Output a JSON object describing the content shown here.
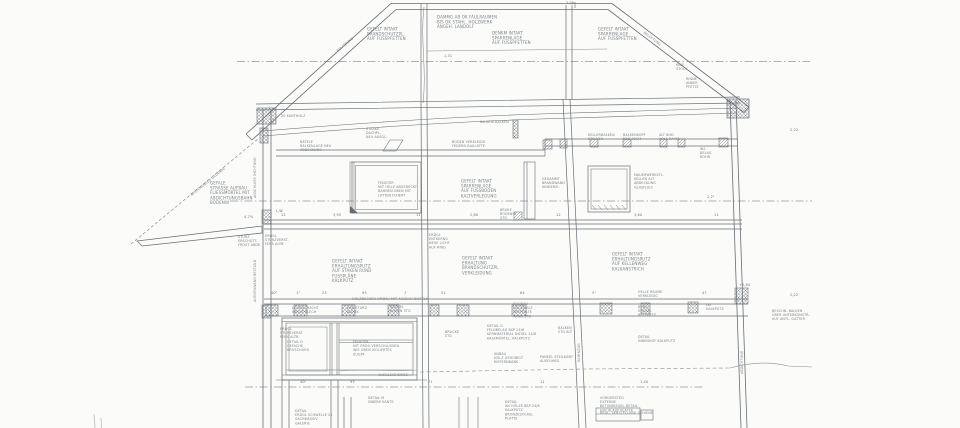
{
  "drawing": {
    "type": "architectural-section-scan",
    "colors": {
      "paper": "#fbfbf9",
      "ink": "#686e74",
      "light_ink": "#8b9095",
      "hatch": "#70767b",
      "centerline": "#94999d",
      "annotation_text": "#7d8388"
    }
  },
  "annotations": [
    {
      "x": 367,
      "y": 27,
      "t": "GEFELT INTAKT\nBRANDSCHUTZPL.\nAUF FUSSPFETTEN"
    },
    {
      "x": 437,
      "y": 15,
      "t": "DÄMMG AB OK FAULRÄUMEN\nBIS OK STAHL. HOLZWERK\nANGEH. LANDOLF"
    },
    {
      "x": 492,
      "y": 31,
      "t": "DENKM INTAKT\nSPARRENLAGE\nAUF FUSSPFETTEN"
    },
    {
      "x": 598,
      "y": 27,
      "t": "GEFELT INTAKT\nSPARRENLAGE\nAUF FUSSPFETTEN"
    },
    {
      "x": 676,
      "y": 63,
      "t": "KNIE-\nSTOCK",
      "c": "xs"
    },
    {
      "x": 686,
      "y": 77,
      "t": "RINNE\nANKER\nPFETTE",
      "c": "xs"
    },
    {
      "x": 336,
      "y": 50,
      "r": -40,
      "t": "BELATTUNG",
      "c": "xs"
    },
    {
      "x": 645,
      "y": 31,
      "r": 37,
      "t": "BELÜFTUNG",
      "c": "xs"
    },
    {
      "x": 480,
      "y": 120,
      "t": "NA KEHLBALKEN",
      "c": "xs"
    },
    {
      "x": 281,
      "y": 114,
      "t": "20 KANTHOLZ",
      "c": "xs"
    },
    {
      "x": 300,
      "y": 140,
      "t": "BATELE\nBALKENLAGE NEU\nABDECKUNG",
      "c": "xs"
    },
    {
      "x": 366,
      "y": 127,
      "t": "STÄRKE\nDACHPL.\nNEU AUSGL.",
      "c": "xs"
    },
    {
      "x": 452,
      "y": 140,
      "t": "BODEN VERKLEIDG\nFEDERN BAULATTE",
      "c": "xs"
    },
    {
      "x": 588,
      "y": 133,
      "t": "KELLERBALKEN\nSTG NEU",
      "c": "xs"
    },
    {
      "x": 623,
      "y": 133,
      "t": "BALKENKOPF\nNEU 20/24",
      "c": "xs"
    },
    {
      "x": 659,
      "y": 133,
      "t": "ALT BHD\nVOLL RAHM",
      "c": "xs"
    },
    {
      "x": 700,
      "y": 147,
      "t": "WS\nBELAG\nROHR",
      "c": "xs"
    },
    {
      "x": 210,
      "y": 181,
      "t": "GEFALE\nSTRASSE AUFBAU\nFLIESSMÖRTEL MIT\nABDICHTUNGSBAHN\nBODENW"
    },
    {
      "x": 378,
      "y": 181,
      "t": "FENSTER\nMIT HOLZ ABGEDECKT\nBAHNEN OBEN MIT\nLATTEN FIXIERT",
      "c": "xs"
    },
    {
      "x": 461,
      "y": 179,
      "t": "GEFELT INTAKT\nSPARRENLAGE\nAUF FUSSBODEN\nKALTVERLEGUNG"
    },
    {
      "x": 542,
      "y": 177,
      "t": "GEDÄMMT\nBRANDWAND\nKINDERZI.",
      "c": "xs"
    },
    {
      "x": 634,
      "y": 173,
      "t": "MAUERWERKSFL.\nKELLEN ALT\nABDECKUNG\nGLASFLIES",
      "c": "xs"
    },
    {
      "x": 500,
      "y": 208,
      "t": "BRÜKE\nBODENPL.\nSTG",
      "c": "xs"
    },
    {
      "x": 707,
      "y": 195,
      "t": "2,2¹",
      "c": "dim"
    },
    {
      "x": 265,
      "y": 234,
      "t": "ERDGL\nSTURZVERST.\nFENS ALTB",
      "c": "xs"
    },
    {
      "x": 429,
      "y": 233,
      "t": "ERDGL\nENTKERNG\nNEUE LICHT\nAUF RING",
      "c": "xs"
    },
    {
      "x": 332,
      "y": 259,
      "t": "GEFELT INTAKT\nERHALTUNGSPUTZ\nAUF STAKEN RUND\nFUSSPLÄNE\nKALKPUTZ"
    },
    {
      "x": 462,
      "y": 256,
      "t": "GEFELT INTAKT\nERHALTUNG\nBRANDSCHUTZPL\nVERKLEIDUNG"
    },
    {
      "x": 612,
      "y": 252,
      "t": "GEFELT INTAKT\nERHALTUNGSPUTZ\nAUF KELLENWEG\nKALKANSTRICH"
    },
    {
      "x": 638,
      "y": 290,
      "t": "HELLE RÄUME\nVERKLEIDG",
      "c": "xs"
    },
    {
      "x": 352,
      "y": 297,
      "t": "HOLZDECKEN UMBAU MIT AUSBAU DISTELN",
      "c": "xs"
    },
    {
      "x": 292,
      "y": 306,
      "t": "LICHTSCHACHT\nWELLE BLECH",
      "c": "xs"
    },
    {
      "x": 347,
      "y": 306,
      "t": "ERD STURZ\nALT BK",
      "c": "xs"
    },
    {
      "x": 390,
      "y": 305,
      "t": "NACKEL\nBODEN STG",
      "c": "xs"
    },
    {
      "x": 513,
      "y": 302,
      "t": "ROHBAU\nHOLZDIELE\nABSTELLTE\nRAND STG",
      "c": "xs"
    },
    {
      "x": 638,
      "y": 305,
      "t": "BERG.\nSOCKEL\nBETONFTE",
      "c": "xs"
    },
    {
      "x": 706,
      "y": 303,
      "t": "LW\nKALKPUTZ",
      "c": "xs"
    },
    {
      "x": 772,
      "y": 309,
      "t": "BESCHN. BALKEN\nÜBER UNTERKONSTR.\nAUF ANTL. GATTER",
      "c": "xs"
    },
    {
      "x": 280,
      "y": 327,
      "t": "ERDGL\nSTURZVERST\nFENS ALTB",
      "c": "xs"
    },
    {
      "x": 287,
      "y": 340,
      "t": "DETAIL D\nGEFACHE\nBROSCHÜRG",
      "c": "xs"
    },
    {
      "x": 353,
      "y": 340,
      "t": "FENSTER\nMIT ERDG VERSCHLÜSSEN\nWIE OBEN ISOLIERTES\nZUGPF",
      "c": "xs"
    },
    {
      "x": 445,
      "y": 330,
      "t": "BRÜCKE\nSTG",
      "c": "xs"
    },
    {
      "x": 487,
      "y": 324,
      "t": "DETAIL G\nFELDBELAG BSP 24/6\nKERNMATERIAL DIESEL 24/8\nKALKMÖRTEL, KALKPUTZ",
      "c": "xs"
    },
    {
      "x": 558,
      "y": 326,
      "t": "BALKEN\nSTG ALT",
      "c": "xs"
    },
    {
      "x": 638,
      "y": 335,
      "t": "DETAIL\nINNENHOF KALKPUTZ",
      "c": "xs"
    },
    {
      "x": 494,
      "y": 352,
      "t": "ANBAU\nHOLZ GEHOBELT\nKIEFERNBANK",
      "c": "xs"
    },
    {
      "x": 540,
      "y": 355,
      "t": "PANEEL STEILKANT\nAUSFÜHRG",
      "c": "xs"
    },
    {
      "x": 378,
      "y": 373,
      "t": "AUSGLEICHSKIES",
      "c": "xs"
    },
    {
      "x": 368,
      "y": 396,
      "t": "DETAIL M\nINNERE KANTE",
      "c": "xs"
    },
    {
      "x": 295,
      "y": 409,
      "t": "DETAIL\nERDGL SCHWELLE 25\nSACHMASSIV\nGALERIE",
      "c": "xs"
    },
    {
      "x": 505,
      "y": 400,
      "t": "DETAIL\nAN HÖLZE BSP 24/6\nKALKPUTZ\nBRONZESOCKEL\nPLATTE",
      "c": "xs"
    },
    {
      "x": 600,
      "y": 396,
      "t": "VORDERSTEG\nEXTERNE\nBETONRIEGEL DETAIL\nHOCHLAUF PLATTE",
      "c": "xs"
    },
    {
      "x": 600,
      "y": 411,
      "t": "BRÜL. VERSTELLUNG SCHIENE",
      "c": "xs"
    },
    {
      "x": 190,
      "y": 194,
      "r": -39,
      "t": "BESTEHENDES GELÄNDE",
      "c": "xs"
    },
    {
      "x": 253,
      "y": 198,
      "r": -90,
      "t": "ANSCHLUSS DICHTUNG",
      "c": "xs"
    },
    {
      "x": 253,
      "y": 302,
      "r": -90,
      "t": "AUSSENWAND BESTAND",
      "c": "xs"
    },
    {
      "x": 577,
      "y": 362,
      "r": -90,
      "t": "KAMINZUG",
      "c": "xs"
    },
    {
      "x": 740,
      "y": 374,
      "r": -90,
      "t": "ABDICHTUNG",
      "c": "xs"
    },
    {
      "x": 238,
      "y": 235,
      "t": "STURZ\nERSCHÜTT.\nFROST ABDK",
      "c": "xs"
    },
    {
      "x": 244,
      "y": 215,
      "t": "4,7%",
      "c": "dim"
    },
    {
      "x": 276,
      "y": 209,
      "t": "L,W",
      "c": "dim"
    },
    {
      "x": 566,
      "y": 1,
      "t": "2,06",
      "c": "dim"
    },
    {
      "x": 444,
      "y": 54,
      "t": "1,31",
      "c": "dim"
    },
    {
      "x": 790,
      "y": 128,
      "t": "2,22",
      "c": "dim"
    },
    {
      "x": 790,
      "y": 293,
      "t": "2,22",
      "c": "dim"
    },
    {
      "x": 739,
      "y": 283,
      "t": "+2,84",
      "c": "dim"
    },
    {
      "x": 281,
      "y": 213,
      "t": "12",
      "c": "dim"
    },
    {
      "x": 333,
      "y": 213,
      "t": "3,95",
      "c": "dim"
    },
    {
      "x": 416,
      "y": 213,
      "t": "11",
      "c": "dim"
    },
    {
      "x": 470,
      "y": 213,
      "t": "2,80",
      "c": "dim"
    },
    {
      "x": 556,
      "y": 213,
      "t": "12",
      "c": "dim"
    },
    {
      "x": 634,
      "y": 213,
      "t": "3,60",
      "c": "dim"
    },
    {
      "x": 714,
      "y": 213,
      "t": "11",
      "c": "dim"
    },
    {
      "x": 271,
      "y": 291,
      "t": "40²",
      "c": "dim"
    },
    {
      "x": 296,
      "y": 291,
      "t": "1¹",
      "c": "dim"
    },
    {
      "x": 322,
      "y": 291,
      "t": "23",
      "c": "dim"
    },
    {
      "x": 362,
      "y": 291,
      "t": "93",
      "c": "dim"
    },
    {
      "x": 404,
      "y": 291,
      "t": "7",
      "c": "dim"
    },
    {
      "x": 441,
      "y": 291,
      "t": "51",
      "c": "dim"
    },
    {
      "x": 520,
      "y": 291,
      "t": "64",
      "c": "dim"
    },
    {
      "x": 592,
      "y": 291,
      "t": "5¹",
      "c": "dim"
    },
    {
      "x": 702,
      "y": 291,
      "t": "47",
      "c": "dim"
    },
    {
      "x": 300,
      "y": 380,
      "t": "40²",
      "c": "dim"
    },
    {
      "x": 350,
      "y": 380,
      "t": "93",
      "c": "dim"
    },
    {
      "x": 428,
      "y": 380,
      "t": "71",
      "c": "dim"
    },
    {
      "x": 540,
      "y": 380,
      "t": "11",
      "c": "dim"
    },
    {
      "x": 640,
      "y": 380,
      "t": "1,40",
      "c": "dim"
    }
  ]
}
